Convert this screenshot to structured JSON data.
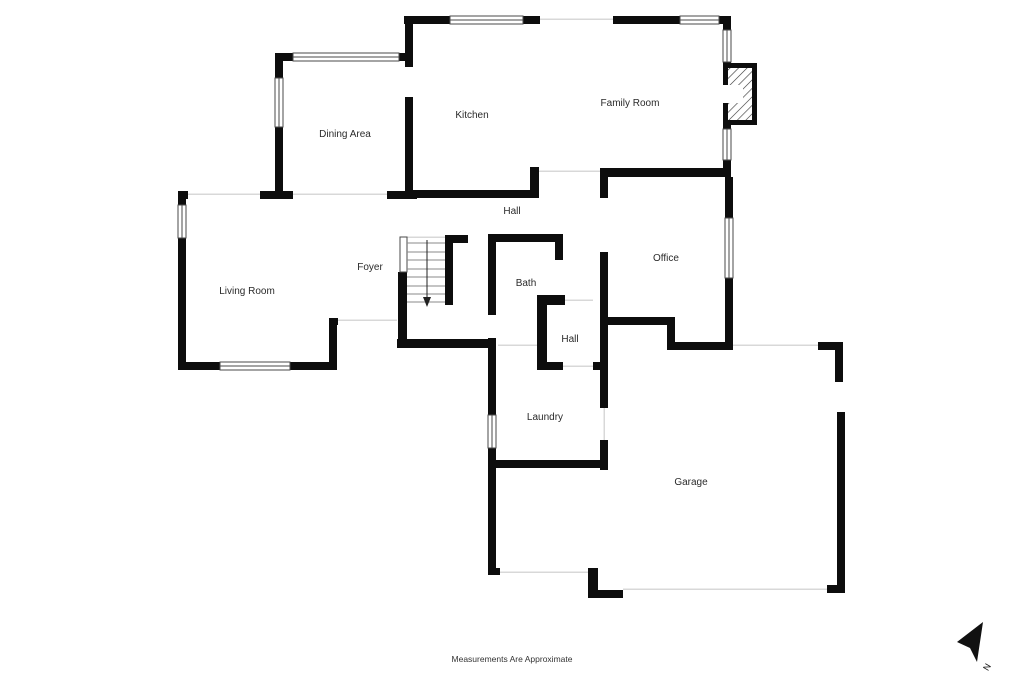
{
  "page": {
    "background": "#ffffff",
    "footer_note": "Measurements Are Approximate"
  },
  "plan": {
    "labels": {
      "dining": "Dining Area",
      "kitchen": "Kitchen",
      "family": "Family Room",
      "hall_upper": "Hall",
      "living": "Living Room",
      "foyer": "Foyer",
      "bath": "Bath",
      "office": "Office",
      "hall_lower": "Hall",
      "laundry": "Laundry",
      "garage": "Garage"
    },
    "compass": {
      "north_label": "N"
    },
    "colors": {
      "wall": "#0d0d0d",
      "opening_line": "#d8d8d8",
      "window_stroke": "#4a4a4a",
      "label_text": "#2a2a2a"
    }
  }
}
